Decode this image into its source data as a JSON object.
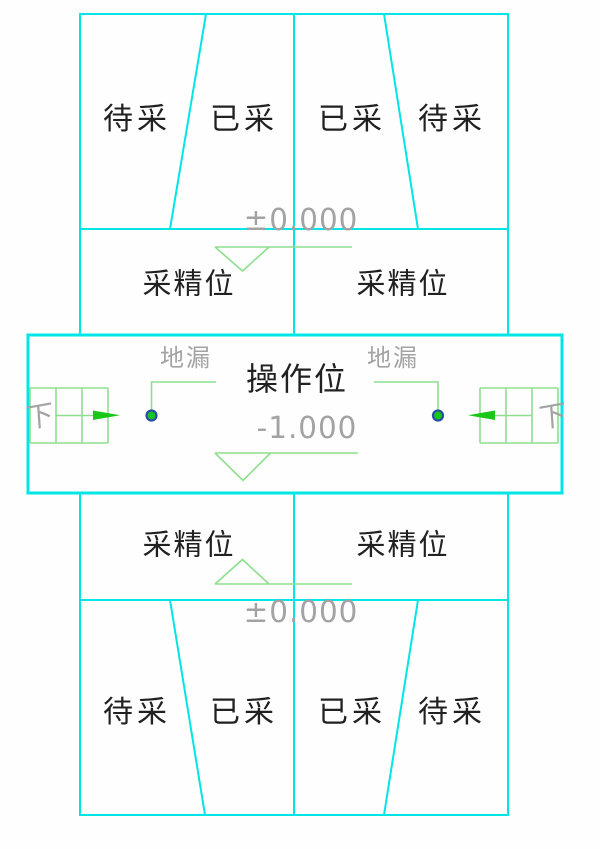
{
  "drawing_type": "mining-operation-floor-plan",
  "colors": {
    "wall_cyan": "#00E5E5",
    "annotation_pale_green": "#8FDE8F",
    "symbol_bright_green": "#17C817",
    "drain_ring_blue": "#2B4EA8",
    "text_dark": "#212121",
    "text_gray": "#A3A3A3"
  },
  "top_block": {
    "cells": [
      "待采",
      "已采",
      "已采",
      "待采"
    ]
  },
  "upper_rooms": {
    "left": "采精位",
    "right": "采精位"
  },
  "operation_band": {
    "title": "操作位",
    "drain_label_left": "地漏",
    "drain_label_right": "地漏",
    "down_label_left": "下",
    "down_label_right": "下"
  },
  "lower_rooms": {
    "left": "采精位",
    "right": "采精位"
  },
  "bottom_block": {
    "cells": [
      "待采",
      "已采",
      "已采",
      "待采"
    ]
  },
  "elevations": {
    "upper": "±0.000",
    "pit": "-1.000",
    "lower": "±0.000"
  },
  "icons": {
    "floor_drain": "green circle with blue ring",
    "stair_grid": "pale green stair grid",
    "direction_arrow": "solid green triangle arrow",
    "elevation_marker": "open triangle on level line"
  }
}
